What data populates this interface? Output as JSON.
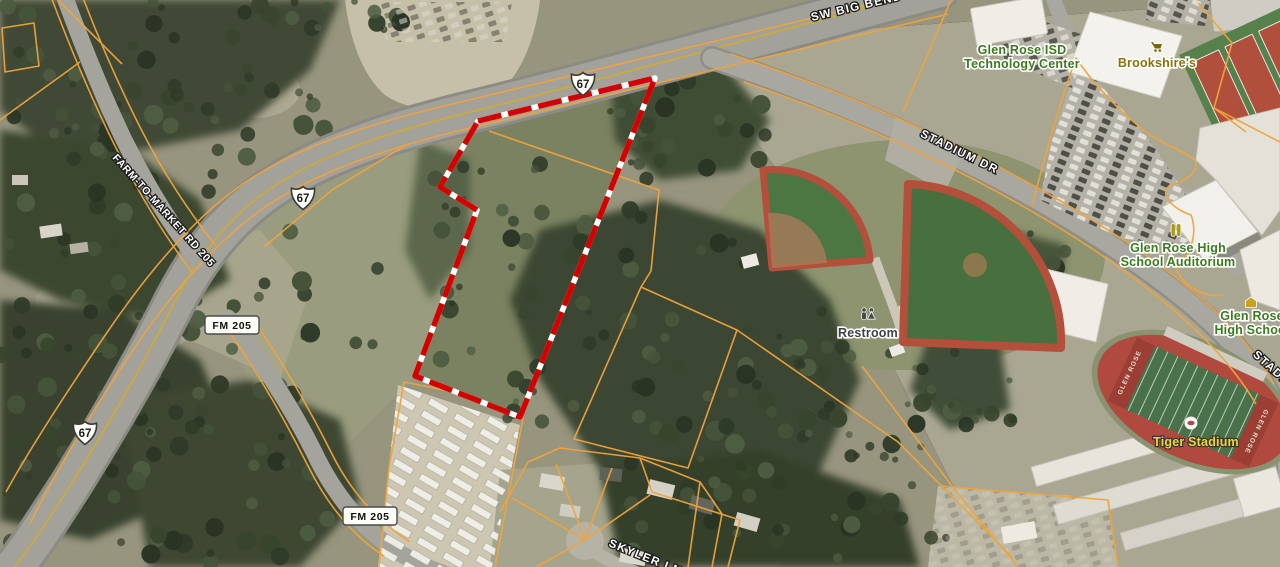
{
  "map": {
    "road_labels": {
      "sw_big_bend": "SW BIG BEND TRL",
      "stadium_dr": "STADIUM DR",
      "farm_to_market": "FARM-TO-MARKET RD 205",
      "skyler": "SKYLER LN"
    },
    "shields": {
      "us67": "67",
      "fm205": "FM 205"
    },
    "pois": {
      "tech_center": {
        "line1": "Glen Rose ISD",
        "line2": "Technology Center"
      },
      "brookshires": {
        "line1": "Brookshire's"
      },
      "auditorium": {
        "line1": "Glen Rose High",
        "line2": "School Auditorium"
      },
      "high_school": {
        "line1": "Glen Rose",
        "line2": "High School"
      },
      "tiger_stadium": {
        "line1": "Tiger Stadium"
      },
      "restroom": {
        "line1": "Restroom"
      }
    },
    "stadium_endzone": "GLEN ROSE",
    "colors": {
      "parcel_line": "#f0a43d",
      "subject_boundary": "#d40000",
      "poi_green": "#3c7a1e",
      "poi_shopping": "#8a7205",
      "poi_stadium_label": "#ecd24a",
      "restroom_label": "#3f4245",
      "road_label": "#ffffff"
    }
  }
}
